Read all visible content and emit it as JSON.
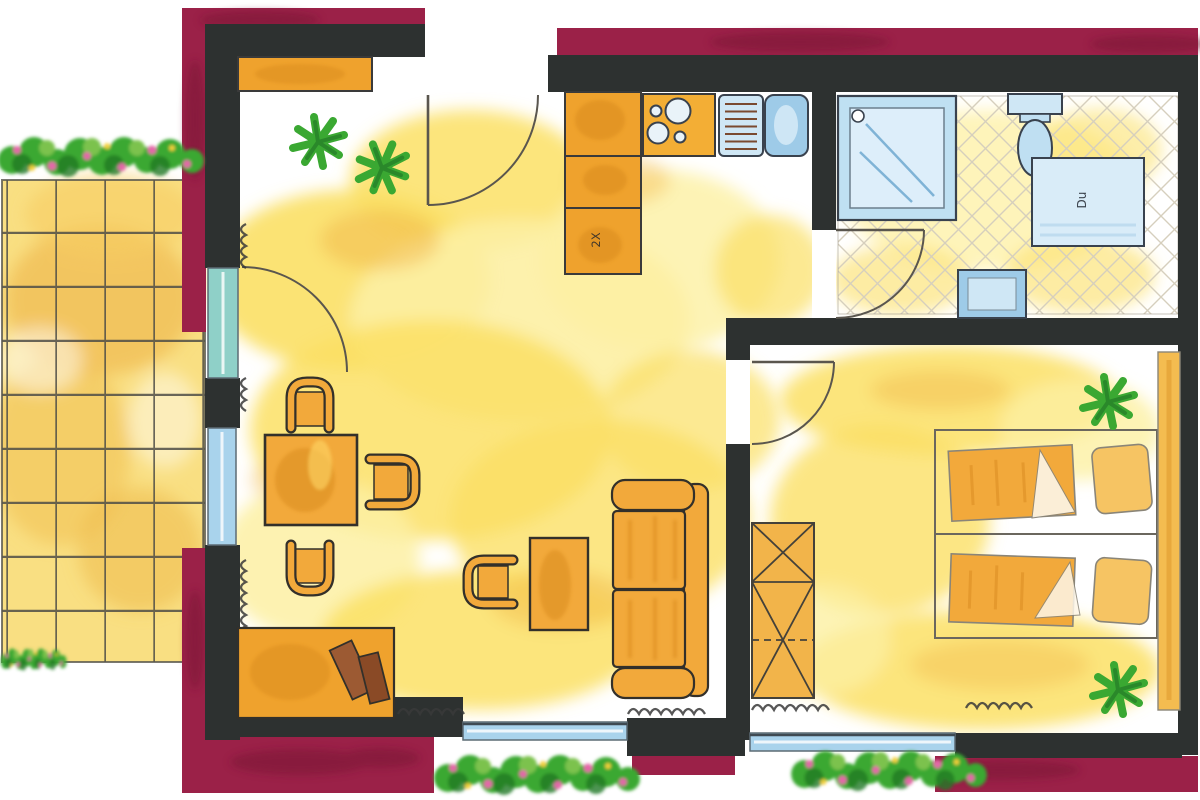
{
  "scene": {
    "type": "floor-plan",
    "style": "watercolor apartment plan"
  },
  "labels": {
    "kitchen_unit": "2X",
    "bath_shower": "Du"
  },
  "palette": {
    "maroon": "#9b2148",
    "maroonDark": "#7a1735",
    "wall": "#2d3130",
    "floorYellow": "#fbe065",
    "floorLight": "#fdf0a3",
    "floorOrange": "#f2b84b",
    "terraceBase": "#f8dc74",
    "counterOrange": "#efa22d",
    "furnOrange": "#f2a93b",
    "furnDark": "#d88a1f",
    "outline": "#3a3a3a",
    "pencil": "#8a8578",
    "glassBlue": "#a9d3ec",
    "glassTeal": "#8fd0c8",
    "fixtureBlue": "#cfe7f5",
    "fixtureDeep": "#9ecbe8",
    "plantGreen": "#3aa832",
    "plantDark": "#237a26",
    "flowerPink": "#e468a8",
    "brown": "#9c5a33",
    "gridLine": "#4f4e46",
    "tileLine": "#d6cfbd",
    "radiator": "#3a3a3a"
  },
  "elements": {
    "rooms": [
      "terrace",
      "living-room",
      "kitchen",
      "bathroom",
      "bedroom"
    ],
    "fixtures": [
      "stove",
      "sink",
      "drainboard",
      "shower",
      "toilet",
      "shower-tray",
      "washbasin"
    ],
    "furniture": [
      "sideboard",
      "dining-table",
      "dining-chairs",
      "armchair",
      "coffee-table",
      "sofa",
      "tv-board",
      "beds",
      "wardrobe",
      "shelf"
    ],
    "decor": [
      "flower-boxes",
      "palm-plants",
      "radiators"
    ]
  }
}
